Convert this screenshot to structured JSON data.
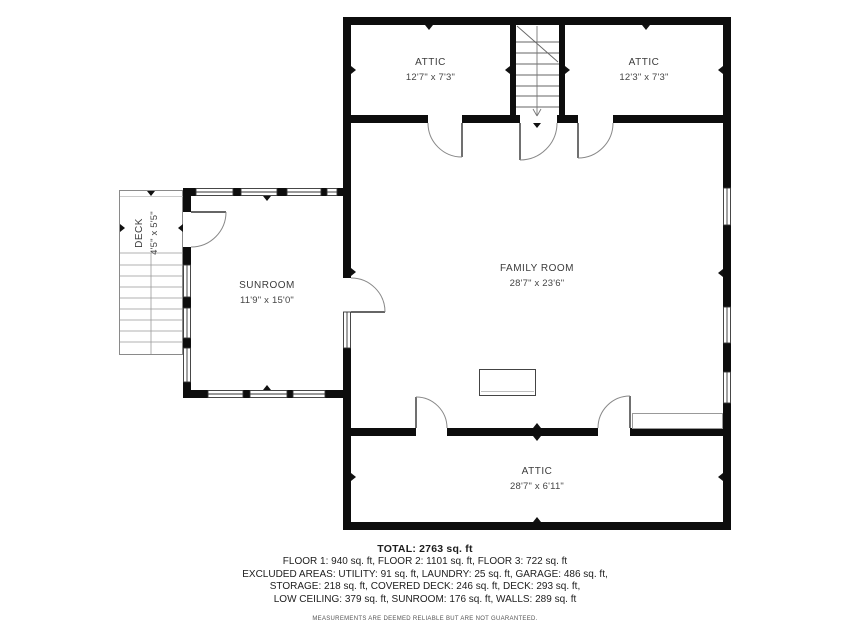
{
  "rooms": {
    "attic_left": {
      "name": "ATTIC",
      "dims": "12'7\" x 7'3\""
    },
    "attic_right": {
      "name": "ATTIC",
      "dims": "12'3\" x 7'3\""
    },
    "family_room": {
      "name": "FAMILY ROOM",
      "dims": "28'7\" x 23'6\""
    },
    "sunroom": {
      "name": "SUNROOM",
      "dims": "11'9\" x 15'0\""
    },
    "deck": {
      "name": "DECK",
      "dims": "4'5\" x 5'5\""
    },
    "attic_bottom": {
      "name": "ATTIC",
      "dims": "28'7\" x 6'11\""
    }
  },
  "summary": {
    "total": "TOTAL: 2763 sq. ft",
    "line1": "FLOOR 1: 940 sq. ft, FLOOR 2: 1101 sq. ft, FLOOR 3: 722 sq. ft",
    "line2": "EXCLUDED AREAS: UTILITY: 91 sq. ft, LAUNDRY: 25 sq. ft, GARAGE: 486 sq. ft,",
    "line3": "STORAGE: 218 sq. ft, COVERED DECK: 246 sq. ft, DECK: 293 sq. ft,",
    "line4": "LOW CEILING: 379 sq. ft, SUNROOM: 176 sq. ft, WALLS: 289 sq. ft",
    "disclaimer": "MEASUREMENTS ARE DEEMED RELIABLE BUT ARE NOT GUARANTEED."
  },
  "colors": {
    "wall": "#0d0d0d",
    "window_frame": "#333333",
    "door_arc": "#888888",
    "stair_line": "#666666",
    "deck_line": "#8a8a8a"
  }
}
